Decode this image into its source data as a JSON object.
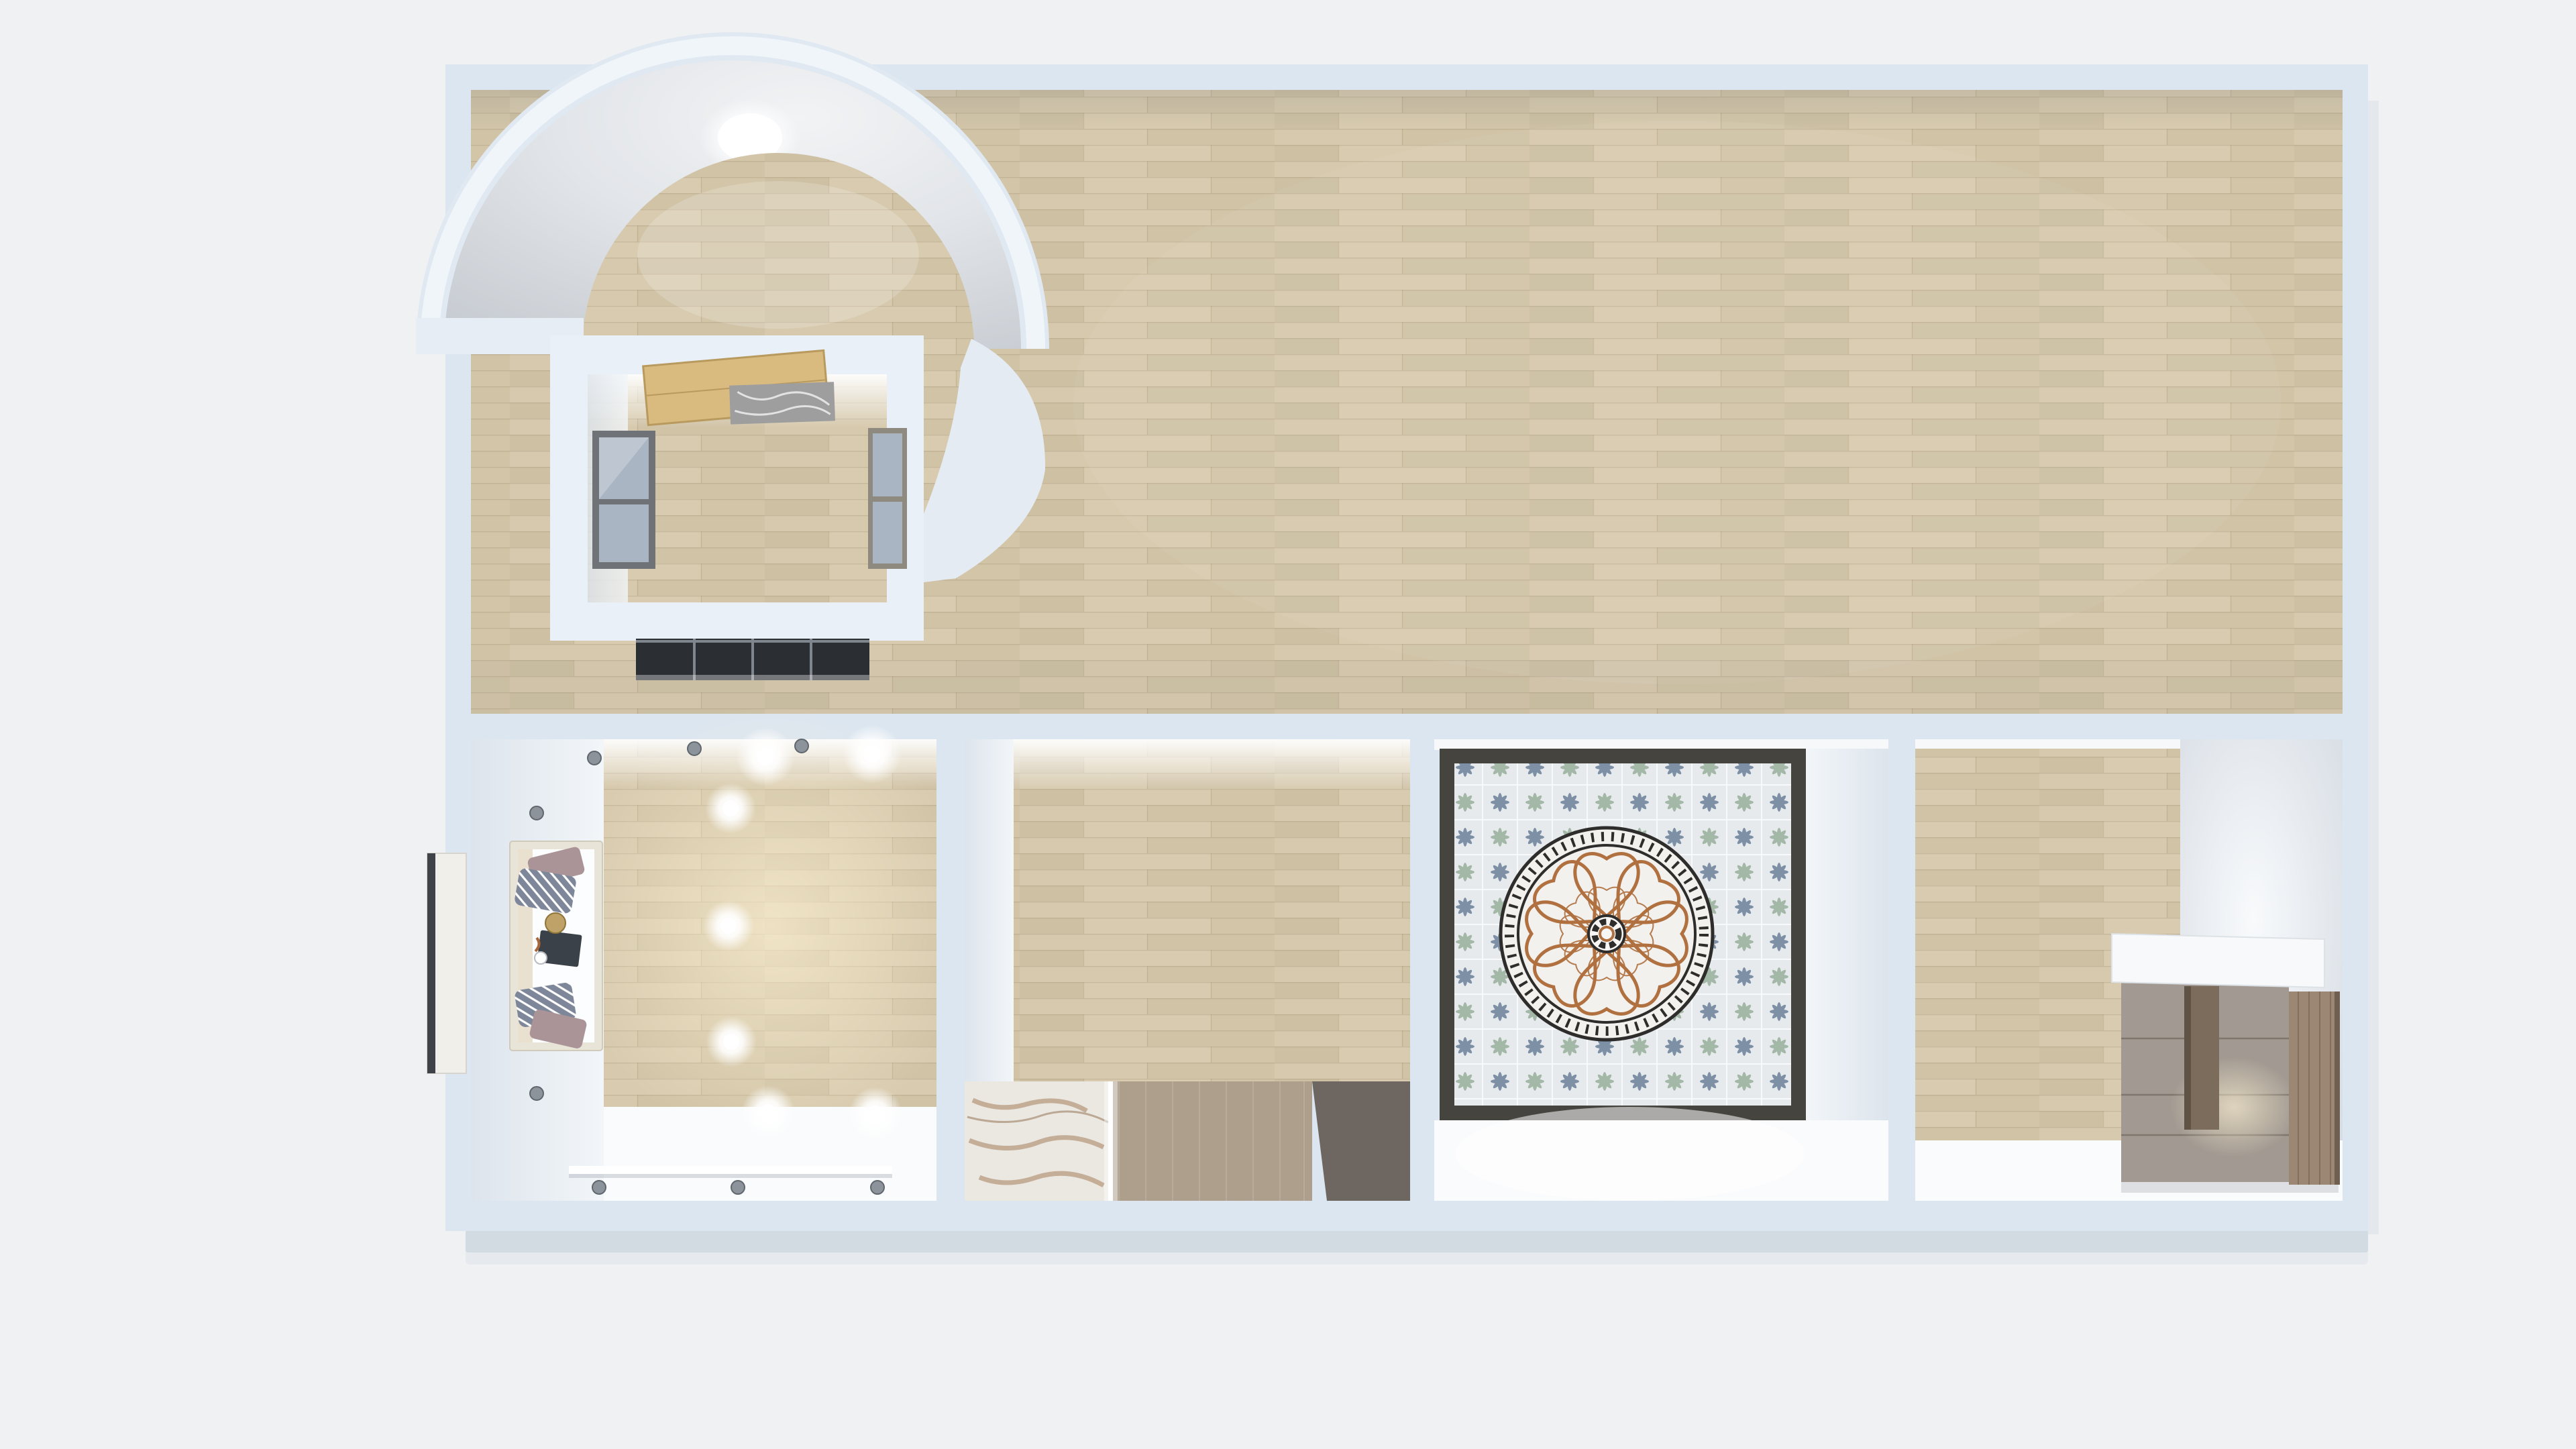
{
  "scene": {
    "title": "3D home floor plan - top-down render",
    "type": "3d-floorplan-top-view",
    "rooms": [
      {
        "id": "great-room",
        "floor": "light-oak-plank",
        "contents": [
          "domed-vault",
          "inner-box-room"
        ]
      },
      {
        "id": "lounge-room",
        "floor": "oak-plank-with-white-strip",
        "contents": [
          "window-seat-nook",
          "pillows",
          "serving-tray",
          "recessed-spotlights",
          "wall-sconces",
          "ledge-shelf",
          "exterior-tv-panel"
        ]
      },
      {
        "id": "bedroom-room",
        "floor": "oak-plank, white-marble, tan-carpet, dark-walkway",
        "contents": [
          "led-strip"
        ]
      },
      {
        "id": "tiled-room",
        "floor": "patterned-cement-tile",
        "contents": [
          "greek-key-medallion",
          "terracotta-rose-inlay"
        ]
      },
      {
        "id": "dressing-room",
        "floor": "oak-plank-and-white",
        "contents": [
          "white-countertop",
          "drawer-cabinet",
          "wood-niche",
          "tall-wardrobe"
        ]
      },
      {
        "id": "attic-box-room",
        "floor": "oak-plank",
        "contents": [
          "open-wood-door",
          "marble-threshold",
          "left-window",
          "right-window",
          "dark-glass-sliders"
        ]
      }
    ],
    "dome": {
      "shape": "half-dome-vault",
      "features": [
        "ceiling-light",
        "arched-opening"
      ]
    },
    "lighting": {
      "spotlight_count": 7,
      "sconce_count": 8,
      "dome_light_count": 1
    }
  },
  "colors": {
    "background": "#f0f1f3",
    "wall": "#dce6f0",
    "wall-light": "#e9f0f7",
    "wall-lighter": "#f0f5fa",
    "terrace": "#d6dce4",
    "wood-base": "#d2c5a9",
    "wood-a": "#d6c9ad",
    "wood-b": "#d0c3a6",
    "wood-c": "#cdc0a3",
    "wood-d": "#d8cbaf",
    "wood-e": "#d2c5a8",
    "wood-seam": "#8b7755",
    "dome-rim": "#f0f5fa",
    "door-wood": "#d9bb80",
    "marble-gray": "#9e9e9e",
    "window-frame": "#6f7377",
    "window-frame-tan": "#8f8a80",
    "window-pane": "#a9b5c2",
    "glass-dark": "#2b2e33",
    "glass-frame": "#80868d",
    "nook-frame": "#e8e4d8",
    "pillow-mauve": "#ab9497",
    "pillow-striped": "#7d8799",
    "tray-dark": "#3a4148",
    "tray-gold": "#bfa268",
    "marble-floor": "#ebe7e1",
    "marble-vein": "#a5805c",
    "carpet-tan": "#ae9f8c",
    "floor-dark": "#6e6660",
    "white-floor": "#fafbfc",
    "tile-base": "#e7eaed",
    "tile-slate": "#7e90a5",
    "tile-sage": "#a3b8a7",
    "tile-border": "#45443e",
    "medallion-terracotta": "#b0703f",
    "medallion-dark": "#2e2d2b",
    "medallion-marble": "#f2f1ee",
    "cabinet-top": "#f7f9fb",
    "cabinet-drawer": "#a29a92",
    "cabinet-niche": "#7c6c5c",
    "wardrobe-wood": "#9b8773",
    "fixture-gray": "#8d939b",
    "tv-panel": "#f1efe9",
    "tv-edge": "#3f4347"
  }
}
